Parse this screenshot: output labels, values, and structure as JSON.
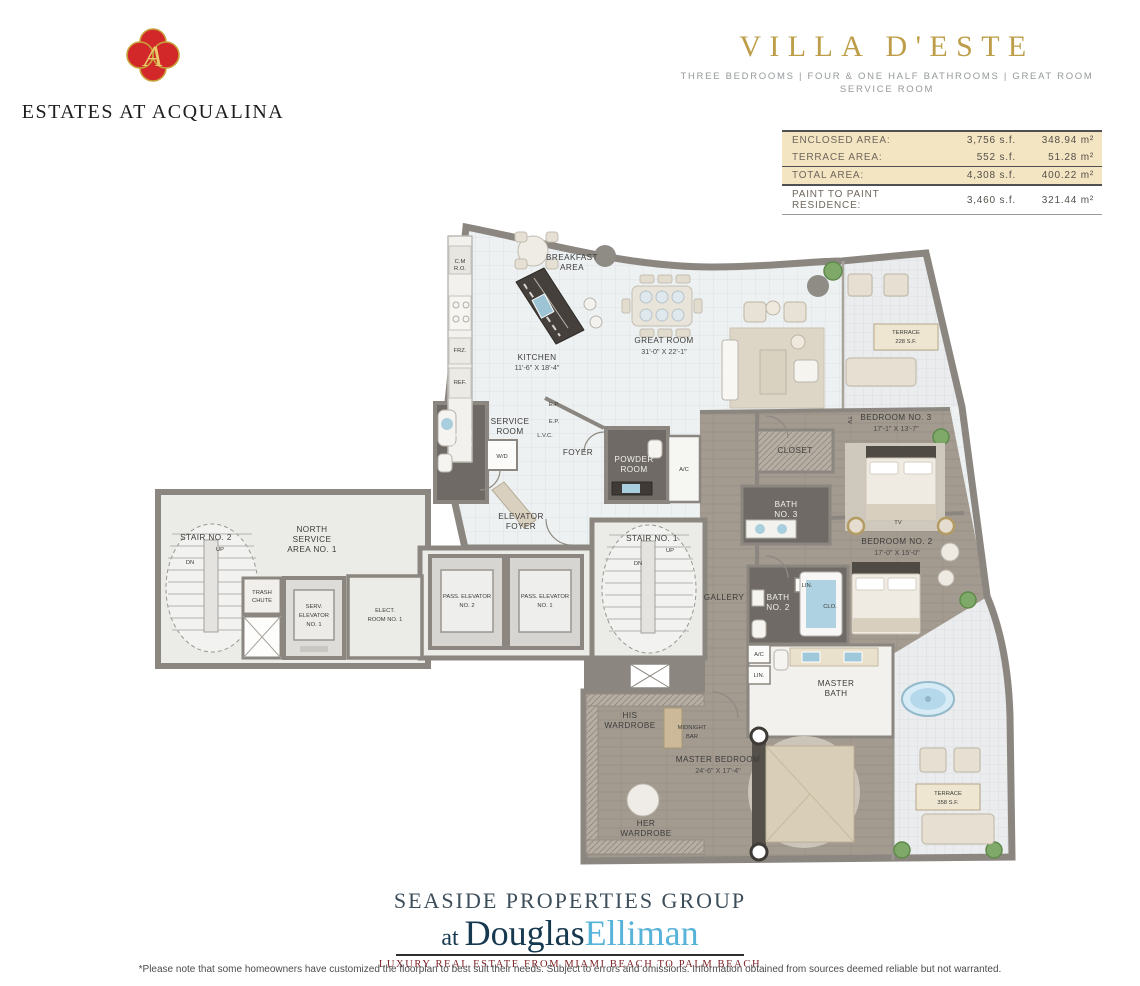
{
  "header": {
    "brand_name": "ESTATES AT ACQUALINA",
    "brand_monogram": "A",
    "title": "VILLA D'ESTE",
    "subtitle_line1": "THREE BEDROOMS | FOUR & ONE HALF BATHROOMS | GREAT ROOM",
    "subtitle_line2": "SERVICE ROOM"
  },
  "area_table": {
    "rows": [
      {
        "label": "ENCLOSED AREA:",
        "sf": "3,756 s.f.",
        "m2": "348.94 m²"
      },
      {
        "label": "TERRACE AREA:",
        "sf": "552 s.f.",
        "m2": "51.28 m²"
      },
      {
        "label": "TOTAL AREA:",
        "sf": "4,308 s.f.",
        "m2": "400.22 m²"
      },
      {
        "label": "PAINT TO PAINT RESIDENCE:",
        "sf": "3,460 s.f.",
        "m2": "321.44 m²"
      }
    ]
  },
  "floorplan": {
    "rooms": {
      "breakfast": {
        "l1": "BREAKFAST",
        "l2": "AREA"
      },
      "kitchen": {
        "name": "KITCHEN",
        "dims": "11'-6\" X 18'-4\""
      },
      "great_room": {
        "name": "GREAT  ROOM",
        "dims": "31'-0\" X 22'-1\""
      },
      "terrace_upper": {
        "l1": "TERRACE",
        "l2": "228 S.F."
      },
      "service_room": {
        "l1": "SERVICE",
        "l2": "ROOM"
      },
      "bath4": {
        "l1": "BATH",
        "l2": "NO. 4"
      },
      "foyer": {
        "name": "FOYER"
      },
      "powder": {
        "l1": "POWDER",
        "l2": "ROOM"
      },
      "elevator_foyer": {
        "l1": "ELEVATOR",
        "l2": "FOYER"
      },
      "stair1": {
        "name": "STAIR NO. 1"
      },
      "stair2": {
        "name": "STAIR NO. 2"
      },
      "north_service": {
        "l1": "NORTH",
        "l2": "SERVICE",
        "l3": "AREA NO. 1"
      },
      "trash": {
        "l1": "TRASH",
        "l2": "CHUTE"
      },
      "serv_elevator": {
        "l1": "SERV.",
        "l2": "ELEVATOR",
        "l3": "NO. 1"
      },
      "elect_room": {
        "l1": "ELECT.",
        "l2": "ROOM NO. 1"
      },
      "pass_elev2": {
        "l1": "PASS. ELEVATOR",
        "l2": "NO. 2"
      },
      "pass_elev1": {
        "l1": "PASS. ELEVATOR",
        "l2": "NO. 1"
      },
      "gallery": {
        "name": "GALLERY"
      },
      "closet": {
        "name": "CLOSET"
      },
      "bedroom3": {
        "name": "BEDROOM  NO. 3",
        "dims": "17'-1\" X 13'-7\""
      },
      "bath3": {
        "l1": "BATH",
        "l2": "NO. 3"
      },
      "bedroom2": {
        "name": "BEDROOM  NO. 2",
        "dims": "17'-0\" X 15'-0\""
      },
      "bath2": {
        "l1": "BATH",
        "l2": "NO. 2"
      },
      "master_bath": {
        "l1": "MASTER",
        "l2": "BATH"
      },
      "his_wardrobe": {
        "l1": "HIS",
        "l2": "WARDROBE"
      },
      "midnight_bar": {
        "l1": "MIDNIGHT",
        "l2": "BAR"
      },
      "master_bedroom": {
        "name": "MASTER  BEDROOM",
        "dims": "24'-6\" X 17'-4\""
      },
      "her_wardrobe": {
        "l1": "HER",
        "l2": "WARDROBE"
      },
      "terrace_lower": {
        "l1": "TERRACE",
        "l2": "358 S.F."
      }
    },
    "small_labels": {
      "wd": "W/D",
      "ac": "A/C",
      "lin": "LIN.",
      "clo": "CLO.",
      "frz": "FRZ.",
      "ref": "REF.",
      "tc": "T.C.",
      "dw": "D.W.",
      "cm": "C.M",
      "ro": "R.O.",
      "ep": "E.P.",
      "lvc": "L.V.C.",
      "up": "UP",
      "dn": "DN",
      "tv": "TV"
    }
  },
  "footer": {
    "group_line": "SEASIDE PROPERTIES GROUP",
    "at": "at ",
    "name_dark": "Douglas",
    "name_light": "Elliman",
    "tagline": "LUXURY REAL ESTATE FROM MIAMI BEACH TO PALM BEACH",
    "disclaimer": "*Please note that some homeowners have customized the floorplan to best suit their needs. Subject to errors and omissions. Information obtained from sources deemed reliable but not warranted."
  },
  "colors": {
    "title_gold": "#bd9d47",
    "logo_red": "#d3282a",
    "logo_gold": "#c8a33c",
    "table_tan": "#f3e4c2",
    "elliman_blue": "#57b3d8",
    "tagline_maroon": "#7b2025",
    "wall_gray": "#8b8780",
    "wood_floor": "#a39a90",
    "tile_floor": "#eef1f2"
  }
}
